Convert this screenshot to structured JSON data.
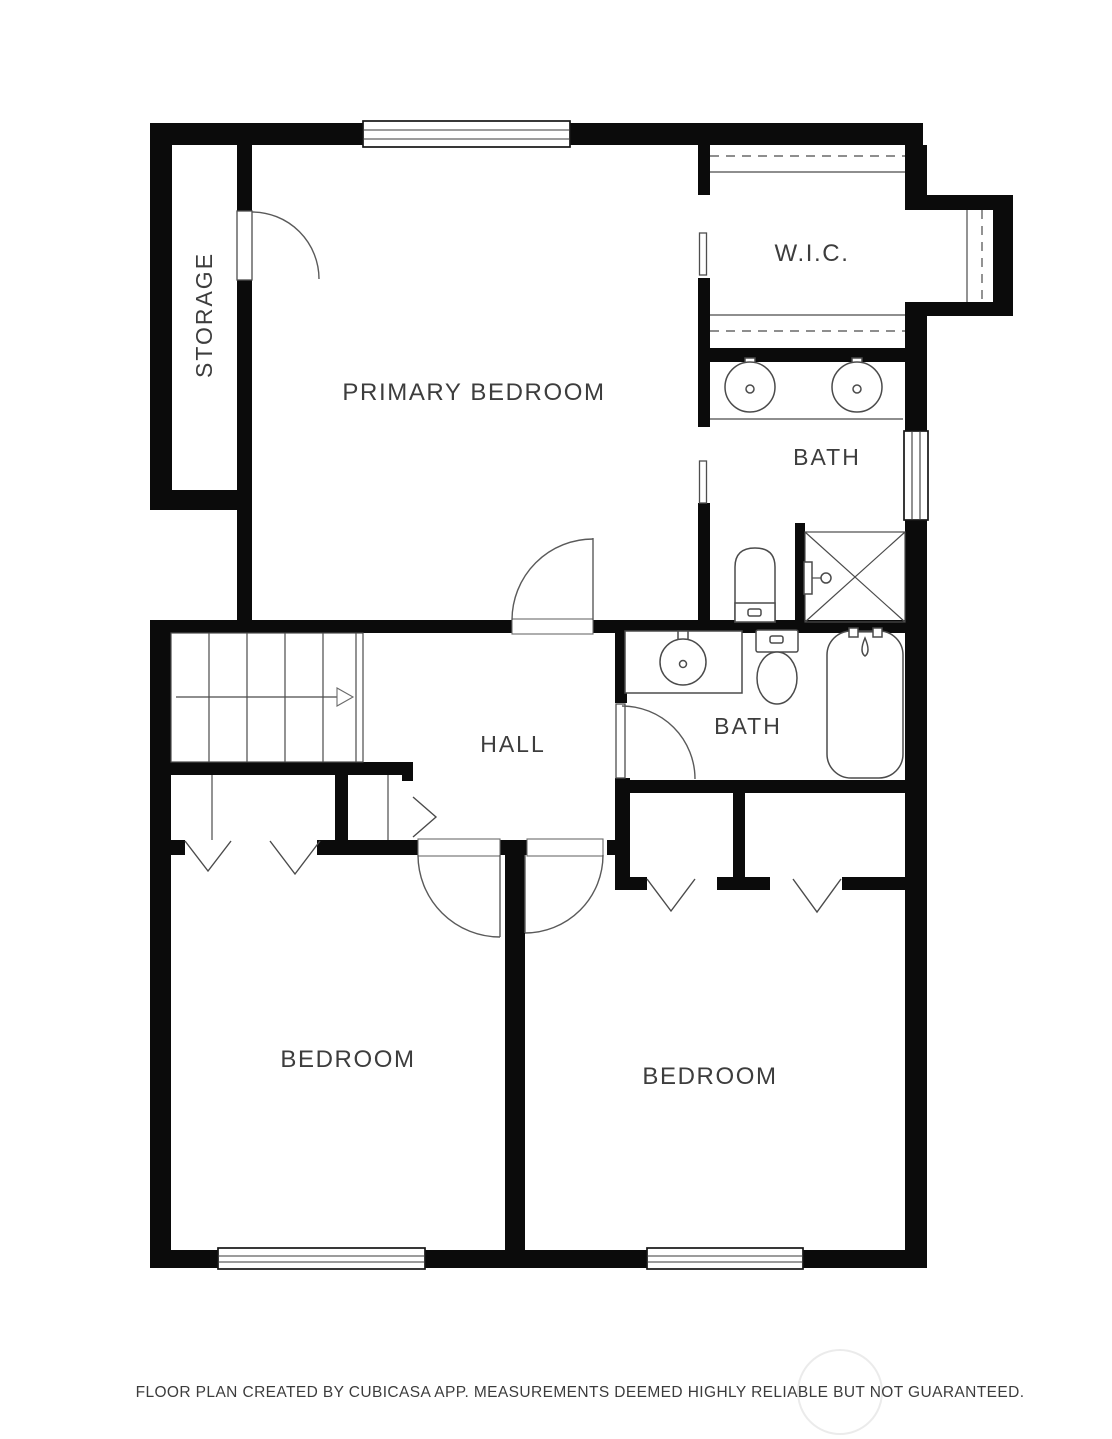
{
  "page": {
    "background": "#ffffff"
  },
  "colors": {
    "wall": "#0b0b0b",
    "line": "#4b4b4b",
    "label_text": "#3d3d3d",
    "footer_text": "#3c3c3c",
    "background": "#ffffff",
    "watermark": "#ebebeb"
  },
  "floor_plan": {
    "rooms": [
      {
        "id": "storage",
        "label": "STORAGE"
      },
      {
        "id": "primary_bedroom",
        "label": "PRIMARY BEDROOM"
      },
      {
        "id": "walk_in_closet",
        "label": "W.I.C."
      },
      {
        "id": "bath_upper",
        "label": "BATH"
      },
      {
        "id": "hall",
        "label": "HALL"
      },
      {
        "id": "bath_lower",
        "label": "BATH"
      },
      {
        "id": "bedroom_left",
        "label": "BEDROOM"
      },
      {
        "id": "bedroom_right",
        "label": "BEDROOM"
      }
    ],
    "fixtures": [
      {
        "name": "double-sink-vanity",
        "room": "bath_upper"
      },
      {
        "name": "toilet",
        "room": "bath_upper"
      },
      {
        "name": "shower",
        "room": "bath_upper"
      },
      {
        "name": "sink-vanity",
        "room": "bath_lower"
      },
      {
        "name": "toilet",
        "room": "bath_lower"
      },
      {
        "name": "bathtub",
        "room": "bath_lower"
      },
      {
        "name": "staircase",
        "room": "hall"
      },
      {
        "name": "closet-rod",
        "room": "walk_in_closet"
      }
    ]
  },
  "footer": {
    "credit": "FLOOR PLAN CREATED BY CUBICASA APP. MEASUREMENTS DEEMED HIGHLY RELIABLE BUT NOT GUARANTEED."
  }
}
